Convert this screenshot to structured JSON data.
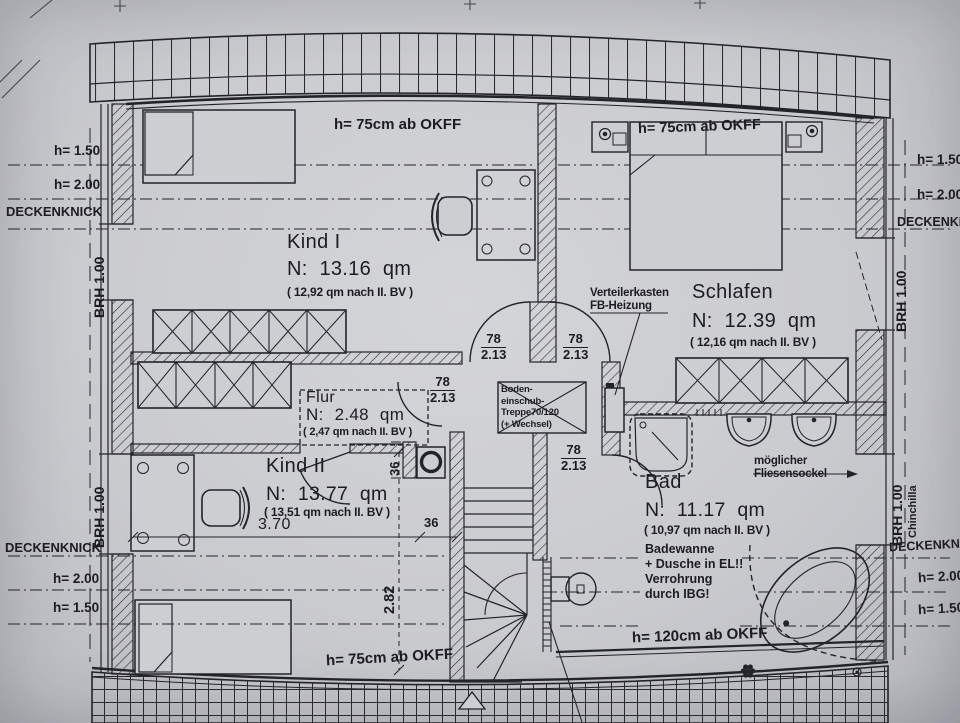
{
  "colors": {
    "paper": "#cbccd0",
    "ink": "#1c1c22"
  },
  "rooms": {
    "kind1": {
      "name": "Kind I",
      "area": "N: 13.16 qm",
      "area_alt": "( 12,92 qm nach II. BV )"
    },
    "schlafen": {
      "name": "Schlafen",
      "area": "N: 12.39 qm",
      "area_alt": "( 12,16 qm nach II. BV )"
    },
    "flur": {
      "name": "Flur",
      "area": "N: 2.48 qm",
      "area_alt": "( 2,47 qm nach II. BV )"
    },
    "kind2": {
      "name": "Kind II",
      "area": "N: 13.77 qm",
      "area_alt": "( 13,51 qm nach II. BV )"
    },
    "bad": {
      "name": "Bad",
      "area": "N: 11.17 qm",
      "area_alt": "( 10,97 qm nach II. BV )",
      "notes": [
        "Badewanne",
        "+ Dusche in EL!!",
        "Verrohrung",
        "durch IBG!"
      ]
    }
  },
  "heights": {
    "top_left": "h= 75cm ab OKFF",
    "top_right": "h= 75cm ab OKFF",
    "bottom_left": "h= 75cm ab OKFF",
    "bottom_right": "h= 120cm ab OKFF"
  },
  "edge": {
    "h150": "h= 1.50",
    "h200": "h= 2.00",
    "deckenknick": "DECKENKNICK",
    "brh": "BRH 1.00",
    "chinchilla": "Chinchilla"
  },
  "door_dim": {
    "width": "78",
    "height": "2.13"
  },
  "dims": {
    "room_width": "3.70",
    "depth": "2.82",
    "thirty_six": "36"
  },
  "annotations": {
    "verteilerkasten": [
      "Verteilerkasten",
      "FB-Heizung"
    ],
    "boden_treppe": [
      "Boden-",
      "einschub-",
      "Treppe70/120",
      "(+ Wechsel)"
    ],
    "fliesensockel": [
      "möglicher",
      "Fliesensockel"
    ]
  }
}
